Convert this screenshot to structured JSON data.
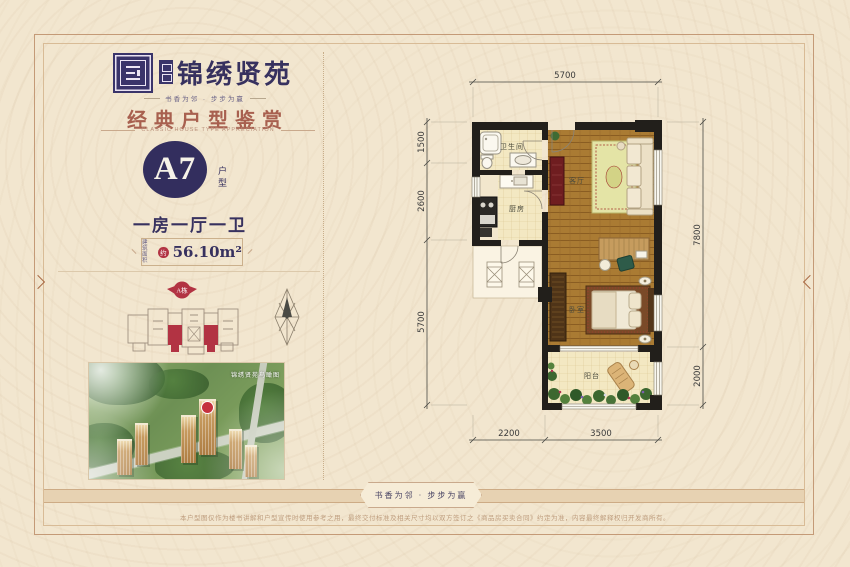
{
  "brand": {
    "name": "锦绣贤苑",
    "tagline": "书香为邻 · 步步为赢"
  },
  "section": {
    "title": "经典户型鉴赏",
    "subtitle": "CLASSIC HOUSE TYPE APPRECIATION"
  },
  "unit": {
    "code": "A7",
    "code_suffix": "户型",
    "layout": "一房一厅一卫",
    "area_label_line1": "建筑",
    "area_label_line2": "面积",
    "area_approx": "约",
    "area_value": "56.10m²"
  },
  "site": {
    "building_badge": "A栋"
  },
  "aerial": {
    "caption": "锦绣贤苑鸟瞰图"
  },
  "floorplan": {
    "rooms": {
      "bathroom": "卫生间",
      "kitchen": "厨房",
      "living": "客厅",
      "bedroom": "卧室",
      "balcony": "阳台"
    },
    "dims": {
      "top": "5700",
      "left": [
        "1500",
        "2600",
        "5700"
      ],
      "right": [
        "7800",
        "2000"
      ],
      "bottom": [
        "2200",
        "3500"
      ]
    }
  },
  "footer": {
    "slogan": "书香为邻 · 步步为赢",
    "disclaimer": "本户型图仅作为楼书讲解和户型宣传时使用参考之用，最终交付标准及相关尺寸均以双方签订之《商品房买卖合同》约定为准，内容最终解释权归开发商所有。"
  },
  "colors": {
    "navy": "#37315f",
    "red": "#b23343",
    "heading": "#a8604f"
  }
}
